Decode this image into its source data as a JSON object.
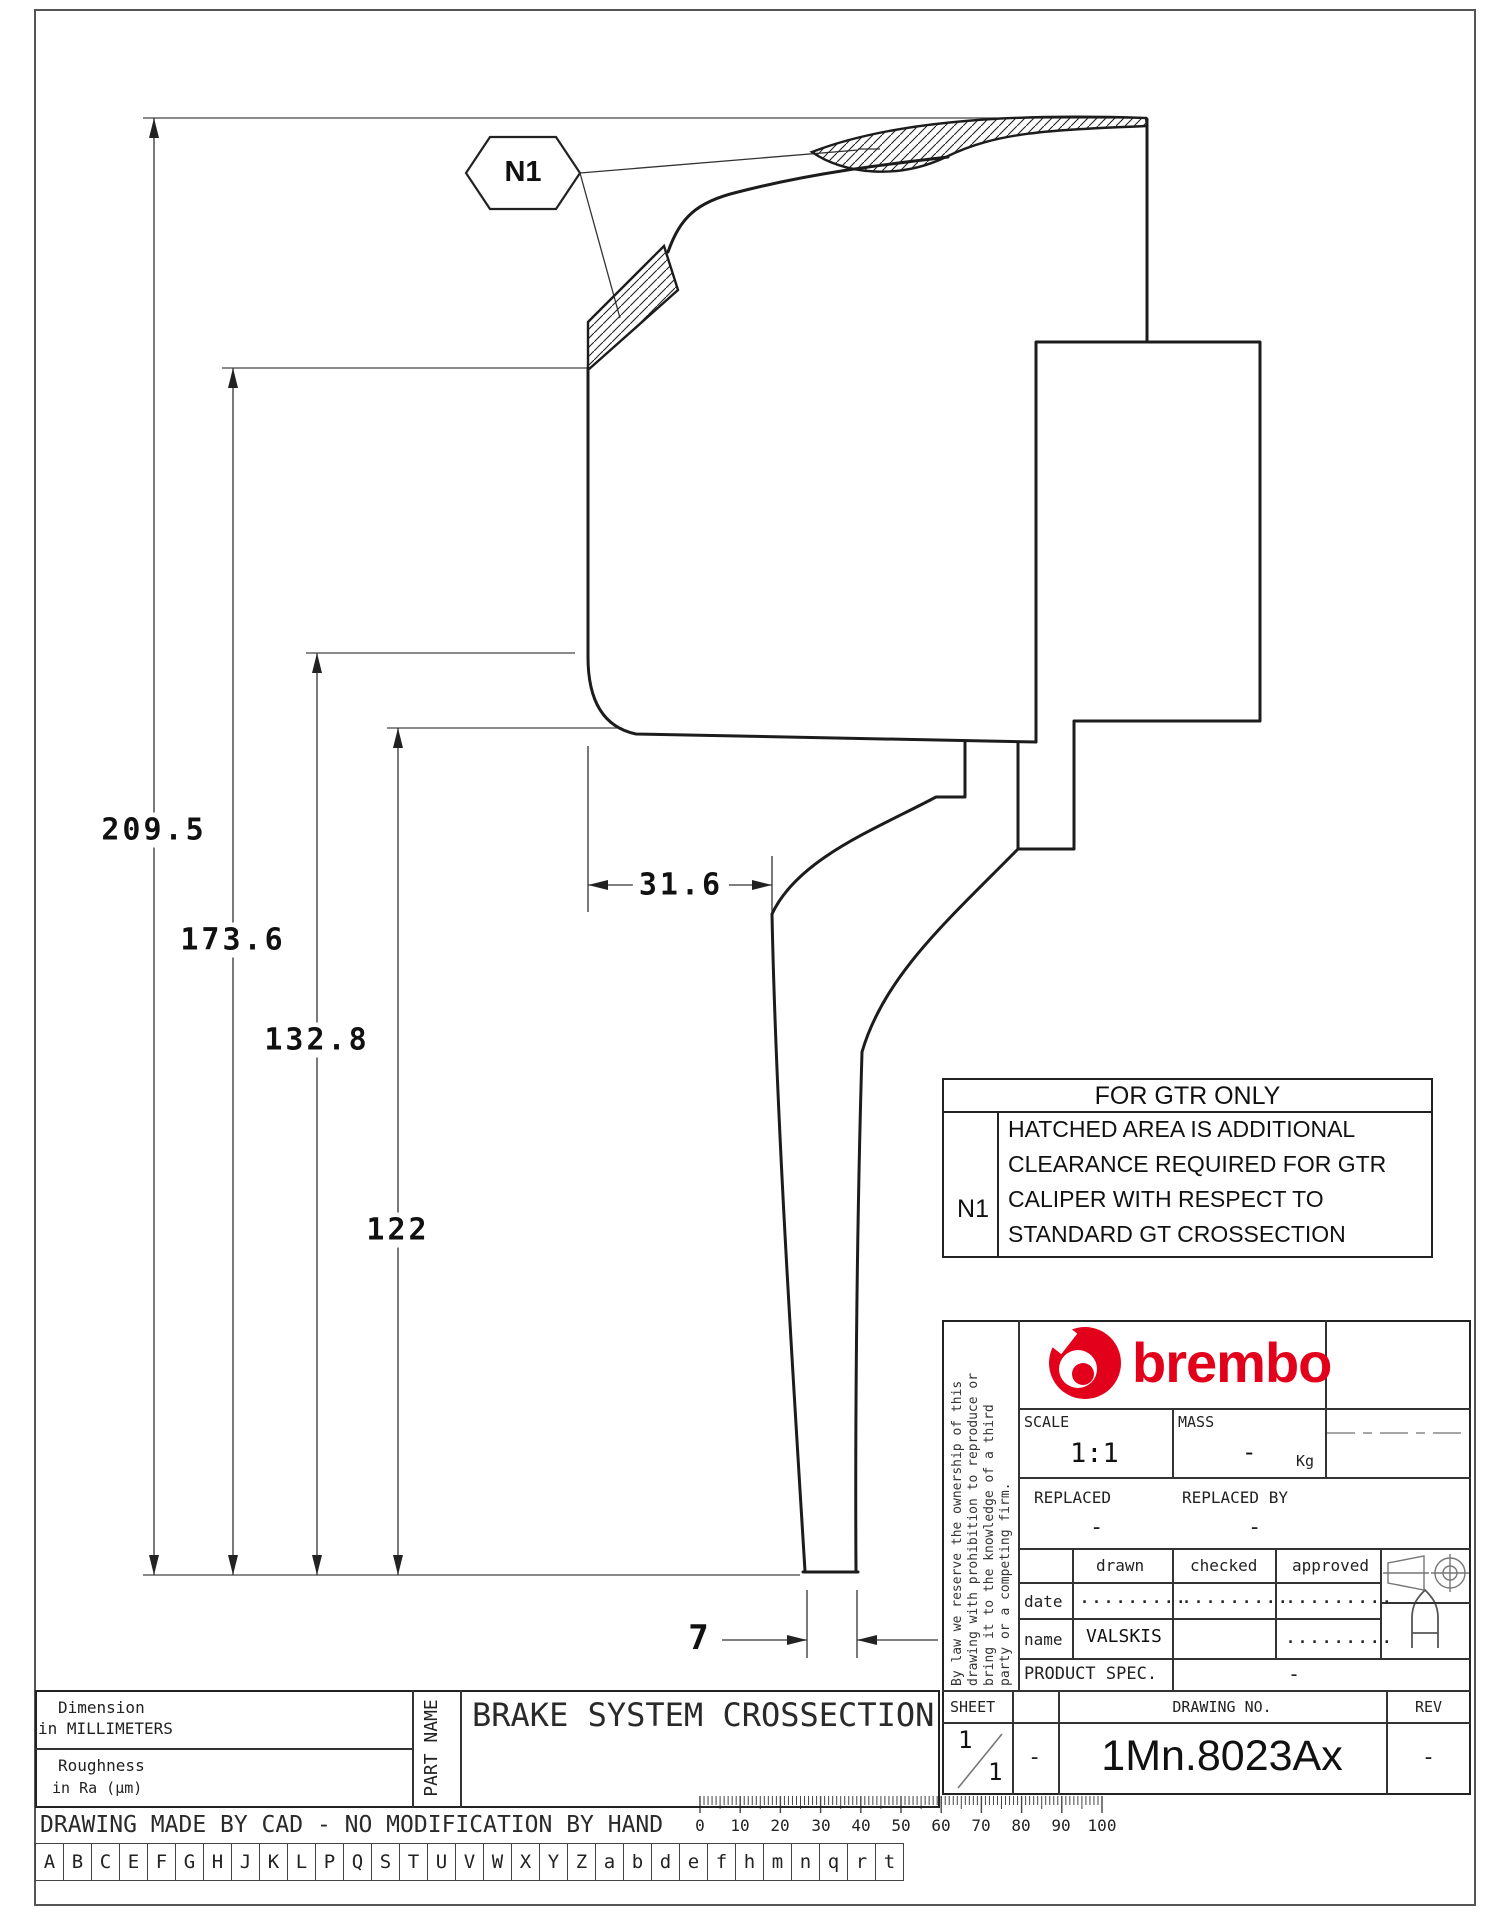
{
  "drawing": {
    "callout_label": "N1",
    "dimensions": {
      "overall_height": "209.5",
      "outer_face": "173.6",
      "inner_face": "132.8",
      "hat_height": "122",
      "face_offset": "31.6",
      "wall_thickness": "7"
    },
    "icons": [
      "n1-hexagon-callout",
      "hatched-clearance-area"
    ]
  },
  "note_table": {
    "title": "FOR GTR ONLY",
    "ref": "N1",
    "lines": [
      "HATCHED AREA IS ADDITIONAL",
      "CLEARANCE REQUIRED FOR GTR",
      "CALIPER WITH RESPECT TO",
      "STANDARD GT CROSSECTION"
    ]
  },
  "title_block": {
    "brand": "brembo",
    "brand_color": "#e2001a",
    "disclaimer_lines": [
      "By law we reserve the ownership of this",
      "drawing with prohibition to reproduce or",
      "bring it to the knowledge of a third",
      "party or a competing firm."
    ],
    "scale_label": "SCALE",
    "scale_value": "1:1",
    "mass_label": "MASS",
    "mass_value": "-",
    "mass_unit": "Kg",
    "replaced_label": "REPLACED",
    "replaced_value": "-",
    "replaced_by_label": "REPLACED BY",
    "replaced_by_value": "-",
    "drawn_label": "drawn",
    "checked_label": "checked",
    "approved_label": "approved",
    "date_label": "date",
    "name_label": "name",
    "date_drawn": ".........",
    "date_checked": ".........",
    "date_approved": ".........",
    "name_drawn": "VALSKIS",
    "name_approved": ".........",
    "product_spec_label": "PRODUCT SPEC.",
    "product_spec_value": "-",
    "sheet_label": "SHEET",
    "sheet_num": "1",
    "sheet_total": "1",
    "sheet_extra": "-",
    "drawing_no_label": "DRAWING NO.",
    "drawing_no": "1Mn.8023Ax",
    "rev_label": "REV",
    "rev_value": "-",
    "icons": [
      "brembo-logo-icon",
      "projection-symbol-icon",
      "format-a-icon"
    ]
  },
  "part_block": {
    "dim_line1": "Dimension",
    "dim_line2": "in MILLIMETERS",
    "rough_line1": "Roughness",
    "rough_line2": "in Ra (μm)",
    "part_name_label": "PART NAME",
    "part_name": "BRAKE SYSTEM CROSSECTION"
  },
  "footer": {
    "cad_note": "DRAWING MADE BY CAD - NO MODIFICATION BY HAND",
    "letters": [
      "A",
      "B",
      "C",
      "E",
      "F",
      "G",
      "H",
      "J",
      "K",
      "L",
      "P",
      "Q",
      "S",
      "T",
      "U",
      "V",
      "W",
      "X",
      "Y",
      "Z",
      "a",
      "b",
      "d",
      "e",
      "f",
      "h",
      "m",
      "n",
      "q",
      "r",
      "t"
    ],
    "ruler": [
      "0",
      "10",
      "20",
      "30",
      "40",
      "50",
      "60",
      "70",
      "80",
      "90",
      "100"
    ]
  }
}
